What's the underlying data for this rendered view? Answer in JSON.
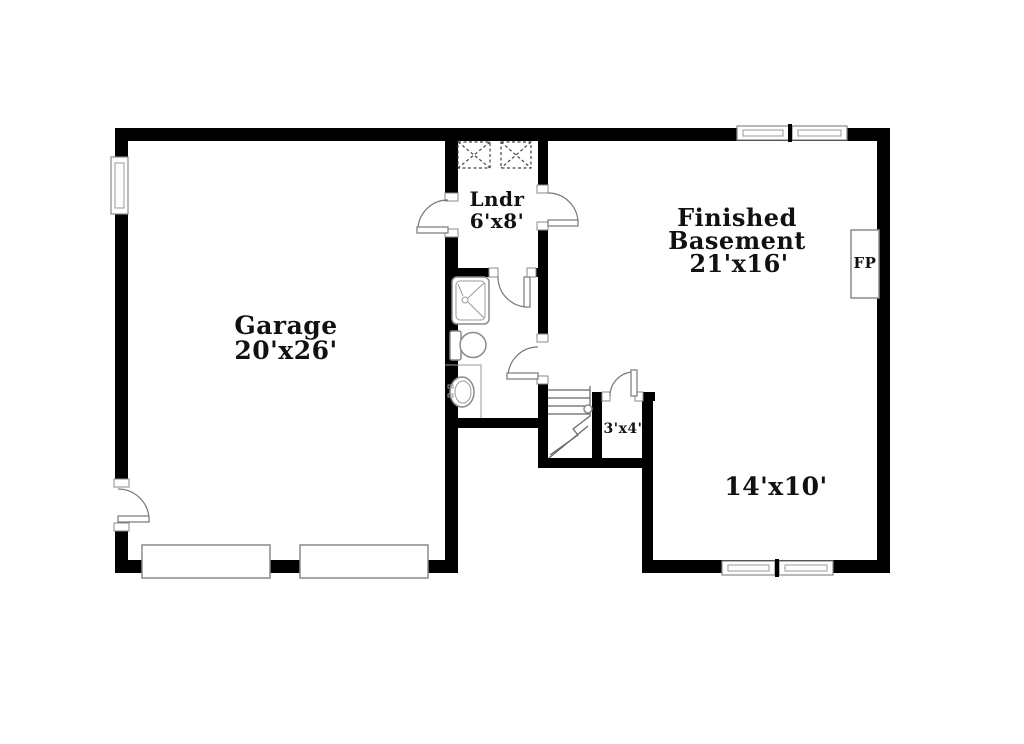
{
  "floorplan": {
    "rooms": {
      "garage": {
        "name": "Garage",
        "dims": "20'x26'"
      },
      "laundry": {
        "name": "Lndr",
        "dims": "6'x8'"
      },
      "basement": {
        "name_line1": "Finished",
        "name_line2": "Basement",
        "dims": "21'x16'"
      },
      "closet": {
        "dims": "3'x4'"
      },
      "rec_area": {
        "dims": "14'x10'"
      },
      "fireplace": {
        "label": "FP"
      }
    },
    "fixtures": [
      "washer",
      "dryer",
      "shower",
      "toilet",
      "sink",
      "stairs",
      "fireplace",
      "garage-doors",
      "windows",
      "doors"
    ],
    "colors": {
      "wall": "#000000",
      "background": "#ffffff",
      "fixture_stroke": "#8a8a8a",
      "text": "#111111"
    }
  }
}
